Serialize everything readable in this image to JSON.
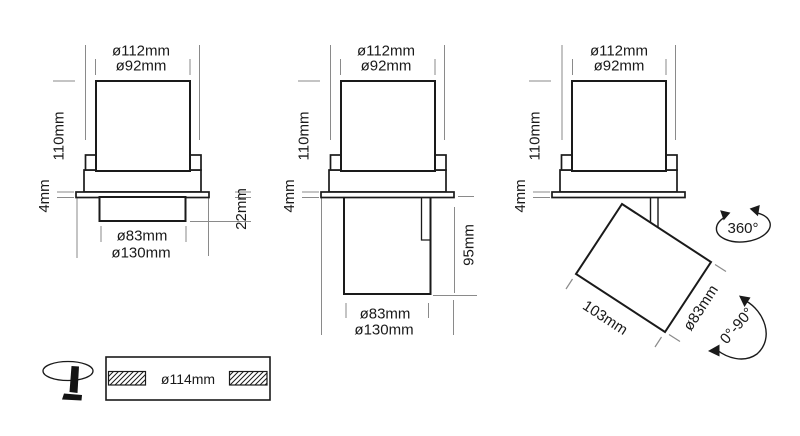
{
  "colors": {
    "outline": "#1a1a1a",
    "dimension_line": "#8a8a8a",
    "background": "#ffffff"
  },
  "views": {
    "recessed": {
      "dia_outer": "ø112mm",
      "dia_inner": "ø92mm",
      "body_height": "110mm",
      "flange_thickness": "4mm",
      "recess_depth": "22mm",
      "dia_body": "ø83mm",
      "dia_flange": "ø130mm"
    },
    "extended": {
      "dia_outer": "ø112mm",
      "dia_inner": "ø92mm",
      "body_height": "110mm",
      "flange_thickness": "4mm",
      "drop_length": "95mm",
      "dia_body": "ø83mm",
      "dia_flange": "ø130mm"
    },
    "tilted": {
      "dia_outer": "ø112mm",
      "dia_inner": "ø92mm",
      "body_height": "110mm",
      "flange_thickness": "4mm",
      "rotation": "360°",
      "body_length": "103mm",
      "dia_body": "ø83mm",
      "tilt_range": "0°-90°"
    },
    "cutout": {
      "dia_cutout": "ø114mm"
    }
  }
}
